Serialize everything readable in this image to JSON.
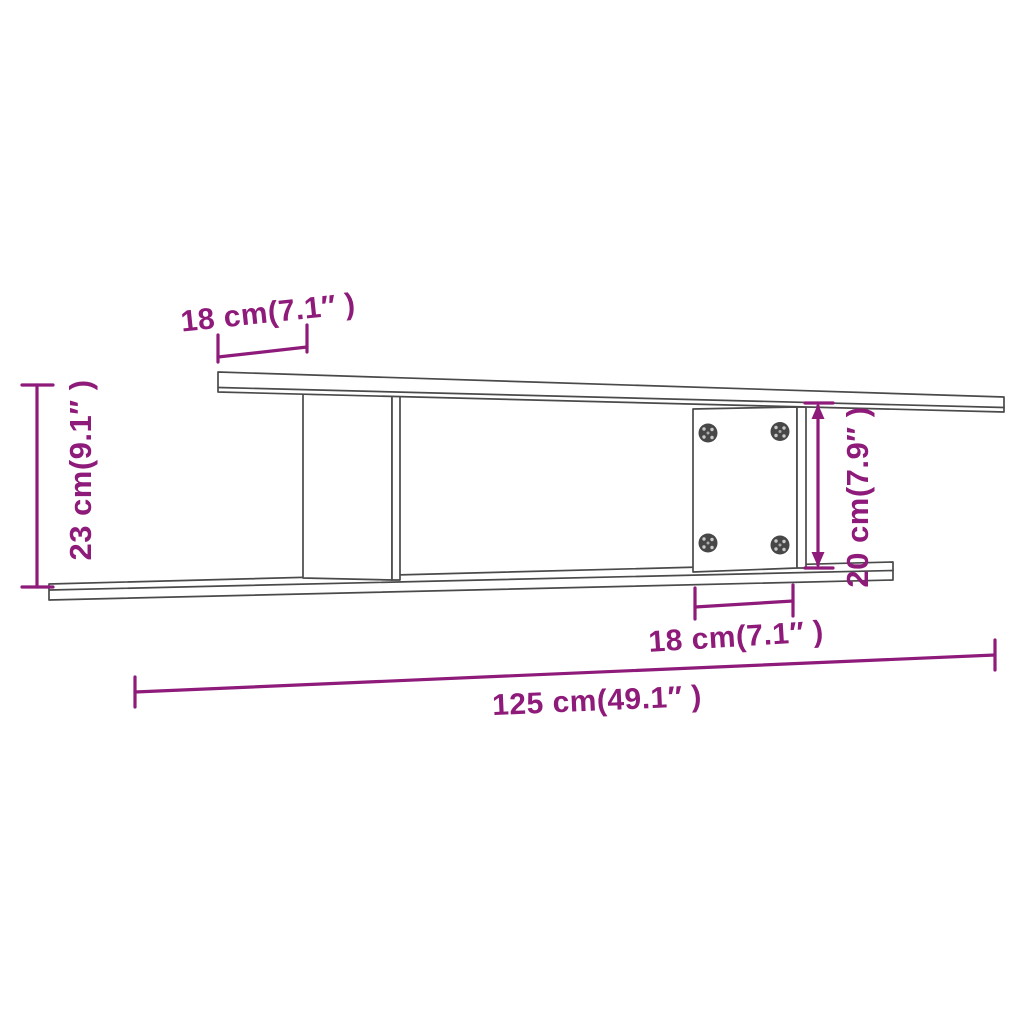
{
  "diagram": {
    "background_color": "#ffffff",
    "outline_color": "#4a4a4a",
    "dimension_color": "#8e1a7a",
    "screw_color": "#474747",
    "dimensions": {
      "top_depth": {
        "label": "18 cm(7.1″ )"
      },
      "left_height": {
        "label": "23 cm(9.1″ )"
      },
      "right_height": {
        "label": "20 cm(7.9″ )"
      },
      "bottom_depth": {
        "label": "18 cm(7.1″ )"
      },
      "total_width": {
        "label": "125 cm(49.1″ )"
      }
    }
  }
}
